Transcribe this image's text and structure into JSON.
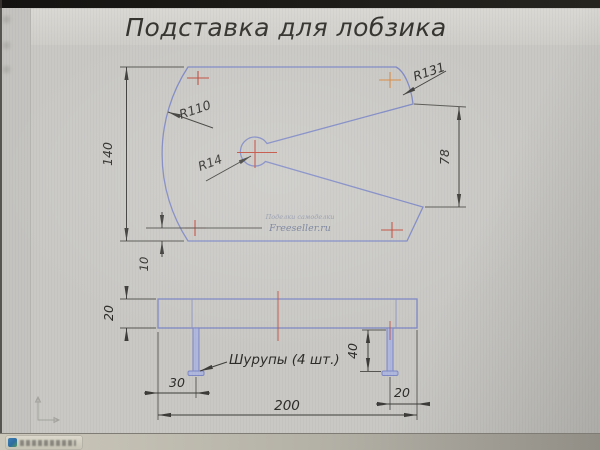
{
  "title": "Подставка для лобзика",
  "top_view": {
    "height_label": "140",
    "bottom_offset_label": "10",
    "right_height_label": "78",
    "radius_left": "R110",
    "radius_notch": "R14",
    "radius_corner": "R131"
  },
  "side_view": {
    "thickness_label": "20",
    "left_screw_offset_label": "30",
    "total_length_label": "200",
    "right_screw_offset_label": "20",
    "screw_length_label": "40",
    "screws_note": "Шурупы (4 шт.)"
  },
  "watermark": {
    "line1": "Поделки самоделки",
    "line2": "Freeseller.ru"
  },
  "colors": {
    "outline_blue": "#7d88c4",
    "dimension_dark": "#3c3b38",
    "center_mark_red": "#c14a3a",
    "center_mark_orange": "#d98a3f",
    "paper_gray": "#c9c8c4"
  }
}
